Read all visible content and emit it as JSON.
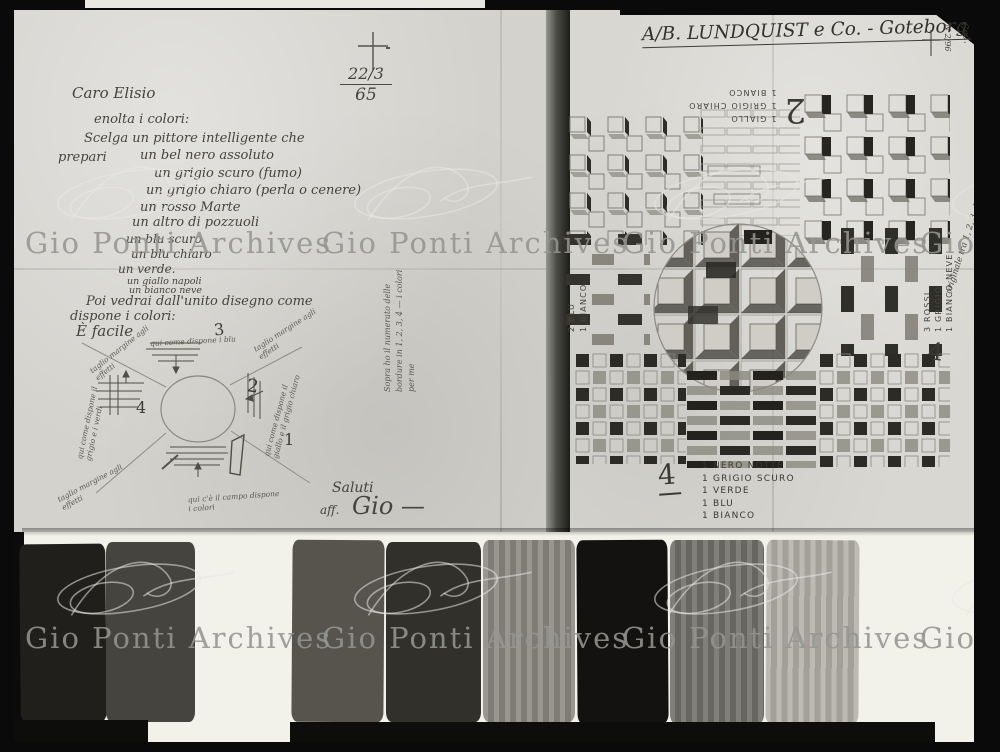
{
  "watermark": {
    "text": "Gio Ponti Archives"
  },
  "left_page": {
    "date_mark": {
      "numerator": "22/3",
      "denominator": "65"
    },
    "salutation": "Caro Elisio",
    "lines": [
      "enolta i colori:",
      "Scelga un pittore intelligente che",
      "prepari",
      "un bel nero assoluto",
      "un grigio scuro (fumo)",
      "un grigio chiaro (perla o cenere)",
      "un rosso Marte",
      "un altro di pozzuoli",
      "un blu scuro",
      "un blu chiaro",
      "un verde.",
      "un giallo napoli",
      "un bianco neve",
      "Poi vedrai dall'unito disegno come",
      "dispone i colori:",
      "È facile"
    ],
    "diagram": {
      "numbers": [
        "1",
        "2",
        "3",
        "4"
      ],
      "notes": [
        "qui come dispone i blu",
        "qui come dispone il giallo e il grigio chiaro",
        "qui c'è il campo dispone i colori",
        "qui come dispone il grigio e i verdi",
        "taglio margine agli effetti",
        "taglio margine agli effetti",
        "taglio margine agli effetti"
      ]
    },
    "fold_note": "Sopra ho il numerato delle\nbordure in 1, 2, 3, 4 — i colori per me",
    "signature": {
      "line1": "Saluti",
      "line2": "aff.",
      "line3": "Gio —"
    }
  },
  "right_page": {
    "header": "A/B. LUNDQUIST e Co. - Goteborg",
    "corner_note": "N 2/96",
    "corner_note2": "Cod.",
    "edge_note": "originale tra 1, 2, 3, 4 — i disegni per me",
    "inverted_label": {
      "number": "2",
      "lines": [
        "1 GIALLO",
        "1 GRIGIO CHIARO",
        "1 BIANCO"
      ]
    },
    "left_label": {
      "number": "3",
      "lines": [
        "2 BLU",
        "1 BIANCO"
      ]
    },
    "right_label": {
      "number": "4",
      "lines": [
        "3 ROSSI",
        "1 GRIGIO",
        "1 BIANCO NEVE"
      ]
    },
    "color_list": {
      "number": "4",
      "items": [
        "1 NERO NOTTE",
        "1 GRIGIO SCURO",
        "1 VERDE",
        "1 BLU",
        "1 BIANCO"
      ]
    }
  },
  "swatches": {
    "colors": [
      "#211f1b",
      "#45443e",
      "#56544d",
      "#31302b",
      "#8c8a82",
      "#141210",
      "#73716a",
      "#b4b2a9"
    ]
  }
}
